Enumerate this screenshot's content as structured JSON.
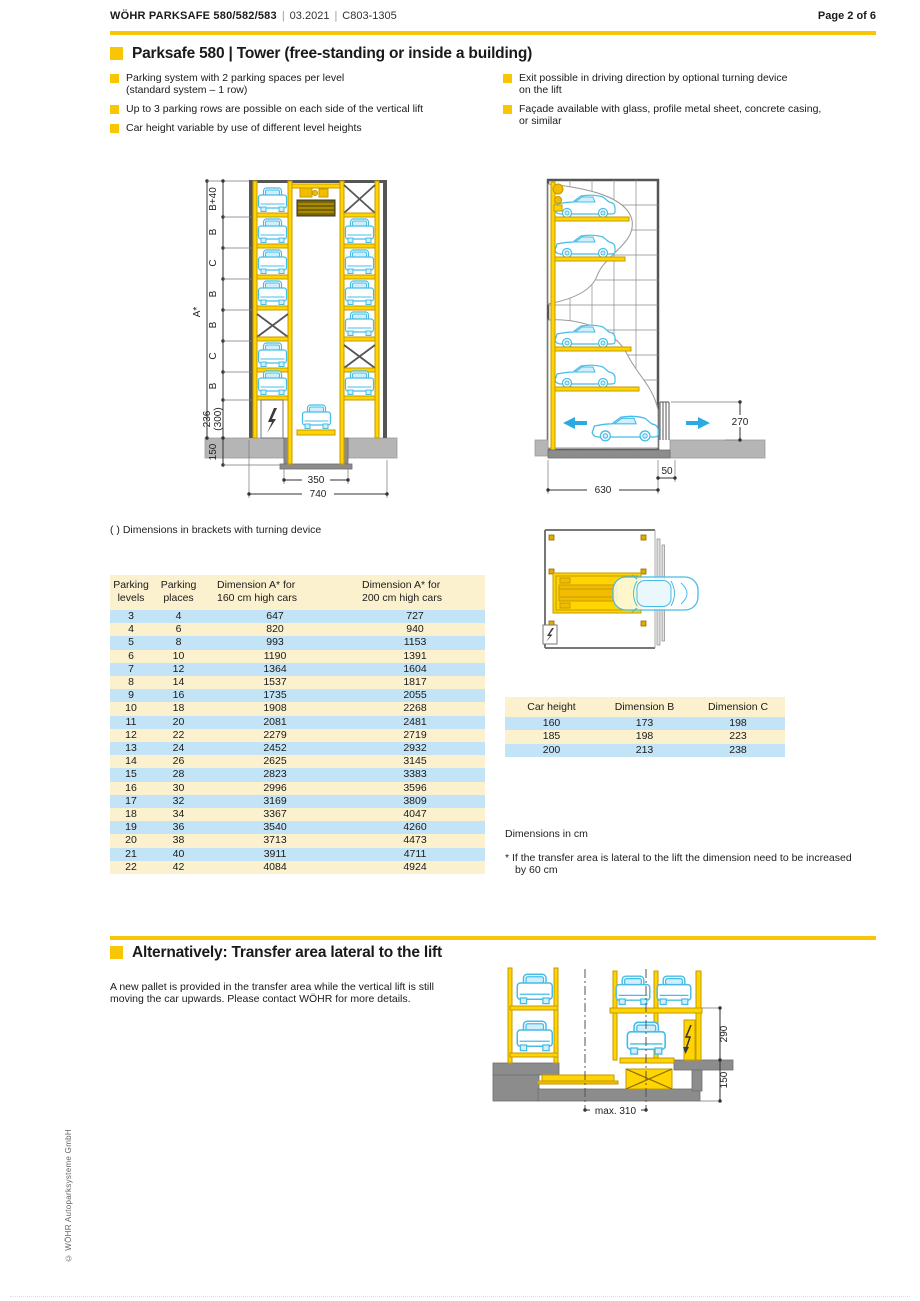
{
  "header": {
    "brand": "WÖHR PARKSAFE 580/582/583",
    "sep": "|",
    "date": "03.2021",
    "code": "C803-1305",
    "page": "Page 2 of 6"
  },
  "section1": {
    "title": "Parksafe 580 | Tower (free-standing or inside a building)",
    "bullets_left": [
      "Parking system with 2 parking spaces per level\n(standard system – 1 row)",
      "Up to 3 parking rows are possible on each side of the vertical lift",
      "Car height variable by use of different level heights"
    ],
    "bullets_right": [
      "Exit possible in driving direction by optional turning device\non the lift",
      "Façade available with glass, profile metal sheet, concrete casing,\nor similar"
    ],
    "brackets_note": "( )  Dimensions in brackets with turning device"
  },
  "front_view": {
    "overall": "A*",
    "seg_labels": [
      "B+40",
      "B",
      "C",
      "B",
      "B",
      "C",
      "B"
    ],
    "pit": "236",
    "pit_alt": "(300)",
    "foundation": "150",
    "pit_width": "350",
    "overall_width": "740"
  },
  "side_view": {
    "entry_height": "270",
    "width": "630",
    "offset": "50"
  },
  "lateral_view": {
    "entry_height": "290",
    "pit_depth": "150",
    "max_width": "max. 310"
  },
  "table_levels": {
    "headers": [
      "Parking\nlevels",
      "Parking\nplaces",
      "Dimension A* for\n160 cm high cars",
      "Dimension A* for\n200 cm high cars"
    ],
    "rows": [
      [
        "3",
        "4",
        "647",
        "727"
      ],
      [
        "4",
        "6",
        "820",
        "940"
      ],
      [
        "5",
        "8",
        "993",
        "1153"
      ],
      [
        "6",
        "10",
        "1190",
        "1391"
      ],
      [
        "7",
        "12",
        "1364",
        "1604"
      ],
      [
        "8",
        "14",
        "1537",
        "1817"
      ],
      [
        "9",
        "16",
        "1735",
        "2055"
      ],
      [
        "10",
        "18",
        "1908",
        "2268"
      ],
      [
        "11",
        "20",
        "2081",
        "2481"
      ],
      [
        "12",
        "22",
        "2279",
        "2719"
      ],
      [
        "13",
        "24",
        "2452",
        "2932"
      ],
      [
        "14",
        "26",
        "2625",
        "3145"
      ],
      [
        "15",
        "28",
        "2823",
        "3383"
      ],
      [
        "16",
        "30",
        "2996",
        "3596"
      ],
      [
        "17",
        "32",
        "3169",
        "3809"
      ],
      [
        "18",
        "34",
        "3367",
        "4047"
      ],
      [
        "19",
        "36",
        "3540",
        "4260"
      ],
      [
        "20",
        "38",
        "3713",
        "4473"
      ],
      [
        "21",
        "40",
        "3911",
        "4711"
      ],
      [
        "22",
        "42",
        "4084",
        "4924"
      ]
    ]
  },
  "table_dims": {
    "headers": [
      "Car height",
      "Dimension B",
      "Dimension C"
    ],
    "rows": [
      [
        "160",
        "173",
        "198"
      ],
      [
        "185",
        "198",
        "223"
      ],
      [
        "200",
        "213",
        "238"
      ]
    ]
  },
  "notes": {
    "units": "Dimensions in cm",
    "asterisk": "* If the transfer area is lateral to the lift the dimension need to be increased by 60 cm"
  },
  "section2": {
    "title": "Alternatively: Transfer area lateral to the lift",
    "paragraph": "A new pallet is provided in the transfer area while the vertical lift is still moving the car upwards. Please contact WÖHR for more details."
  },
  "footer": {
    "copyright": "© WÖHR Autoparksysteme GmbH"
  },
  "colors": {
    "accent": "#f9c606",
    "table_cream": "#fbf1cf",
    "table_blue": "#c3e4f6",
    "diagram_yellow": "#ffd400",
    "car_blue": "#45bde8"
  }
}
